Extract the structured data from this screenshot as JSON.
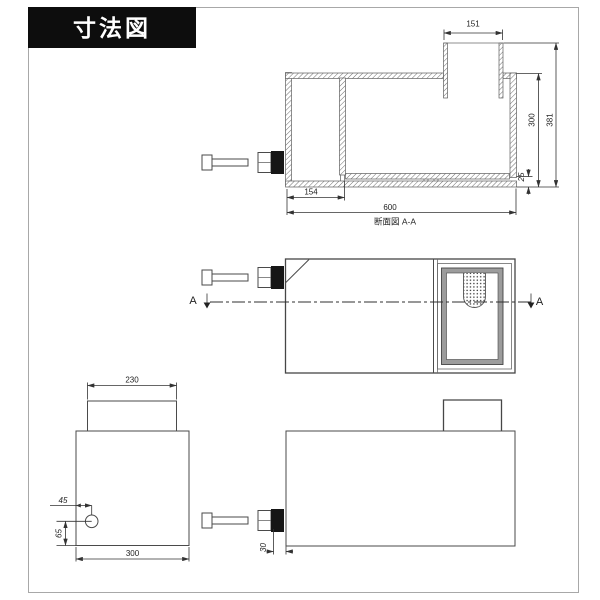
{
  "title": "寸法図",
  "section_view": {
    "caption": "断面図 A-A",
    "dim_top_width": "151",
    "dim_inner_height": "300",
    "dim_total_height": "381",
    "dim_base_height": "25",
    "dim_partition_offset": "154",
    "dim_total_width": "600"
  },
  "plan_view": {
    "section_label_left": "A",
    "section_label_right": "A"
  },
  "front_view": {
    "dim_lid_width": "230",
    "dim_outlet_from_left": "45",
    "dim_outlet_from_bottom": "65",
    "dim_body_width": "300"
  },
  "side_view": {
    "dim_outlet_protrusion": "30"
  },
  "colors": {
    "line": "#4a4a4a",
    "title_bg": "#0d0d0d",
    "title_fg": "#ffffff"
  }
}
